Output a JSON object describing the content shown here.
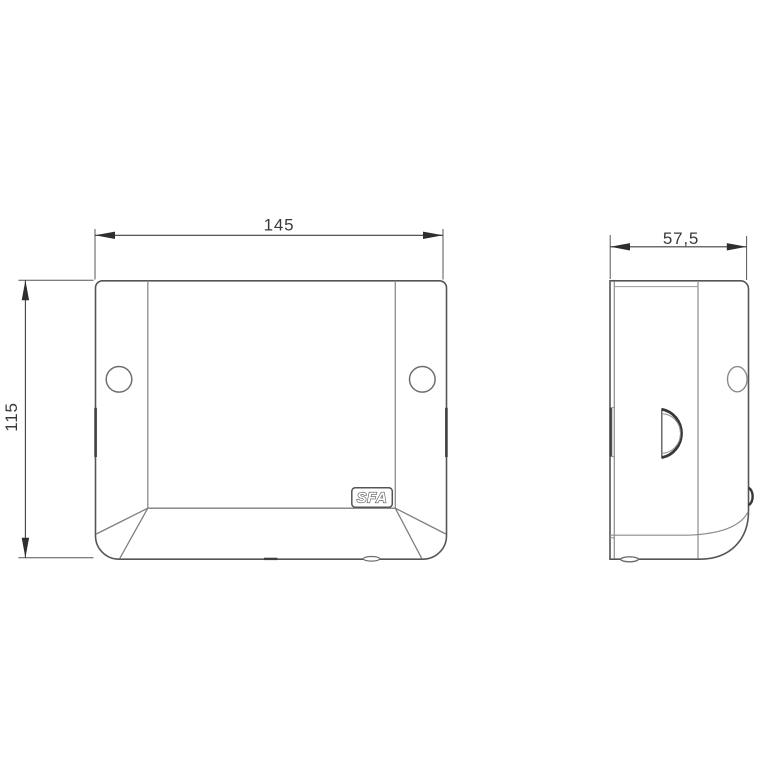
{
  "drawing": {
    "dimensions": {
      "front_width": "145",
      "front_height": "115",
      "side_depth": "57,5"
    },
    "logo": {
      "text": "SFA"
    },
    "colors": {
      "background": "#ffffff",
      "outline": "#555555",
      "inner_line": "#8c8c8c",
      "dimension_line": "#3f3f3f",
      "arrow_fill": "#2e2e2e",
      "text": "#3a3a3a"
    }
  }
}
